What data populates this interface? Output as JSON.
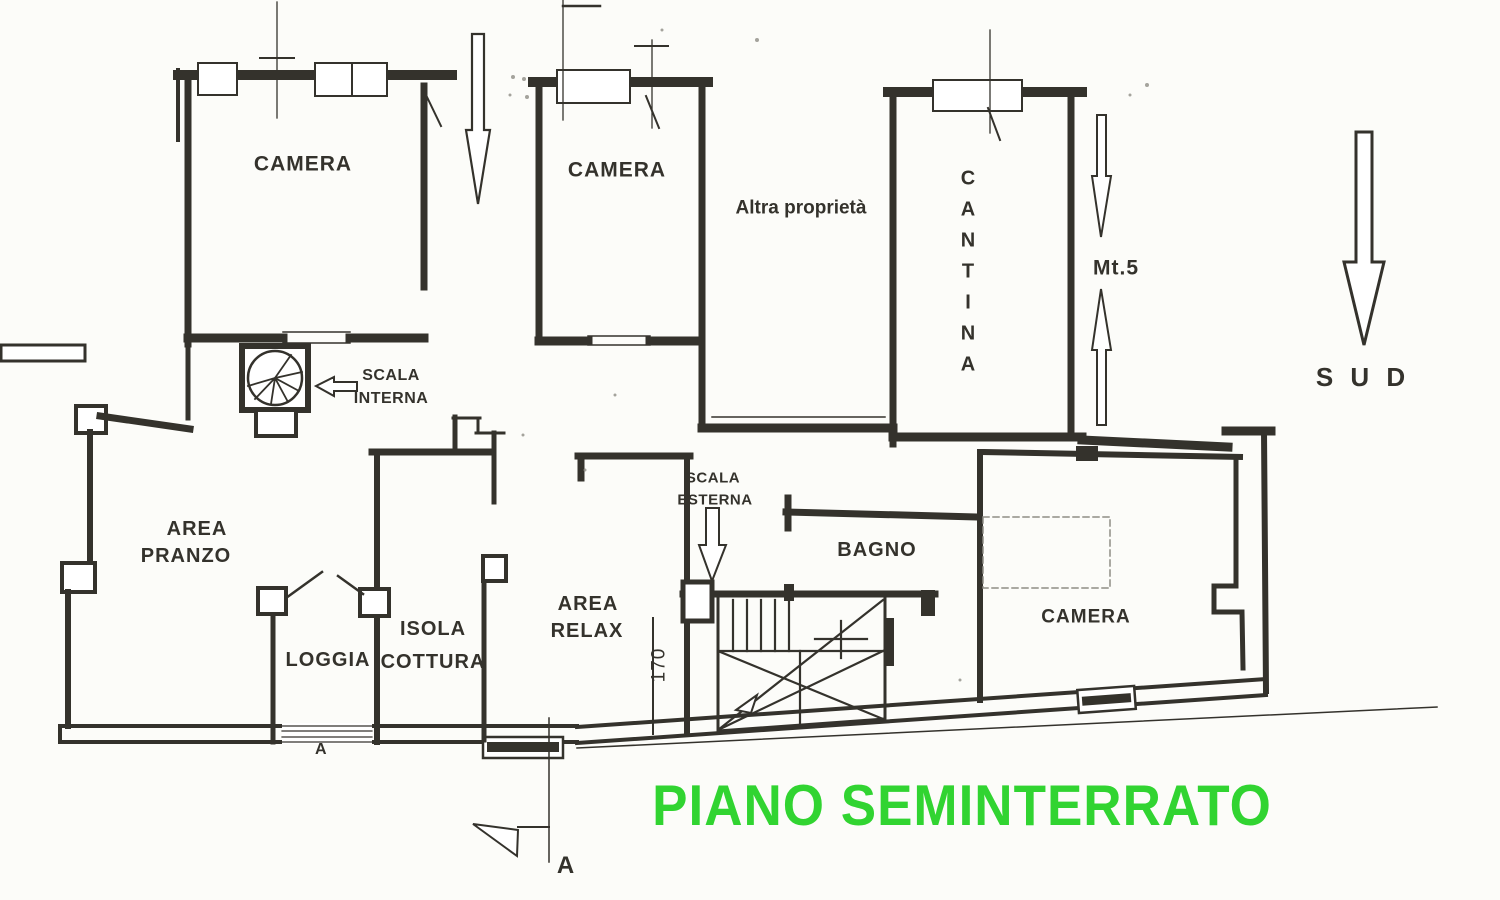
{
  "document": {
    "type": "floor-plan",
    "floor_title": "PIANO SEMINTERRATO"
  },
  "labels": {
    "camera_nw": "CAMERA",
    "camera_n": "CAMERA",
    "camera_se": "CAMERA",
    "altra_proprieta": "Altra proprietà",
    "cantina": "CANTINA",
    "area_pranzo": [
      "AREA",
      "PRANZO"
    ],
    "loggia": "LOGGIA",
    "isola_cottura": [
      "ISOLA",
      "COTTURA"
    ],
    "area_relax": [
      "AREA",
      "RELAX"
    ],
    "bagno": "BAGNO",
    "scala_interna": [
      "SCALA",
      "INTERNA"
    ],
    "scala_esterna": [
      "SCALA",
      "ESTERNA"
    ],
    "mt5": "Mt.5",
    "sud": "S U D",
    "dim_170": "170",
    "section_marker_loggia": "A",
    "section_marker_bottom": "A"
  },
  "colors": {
    "wall_ink": "#34322c",
    "title_green": "#31d431",
    "paper": "#fcfcf9"
  }
}
